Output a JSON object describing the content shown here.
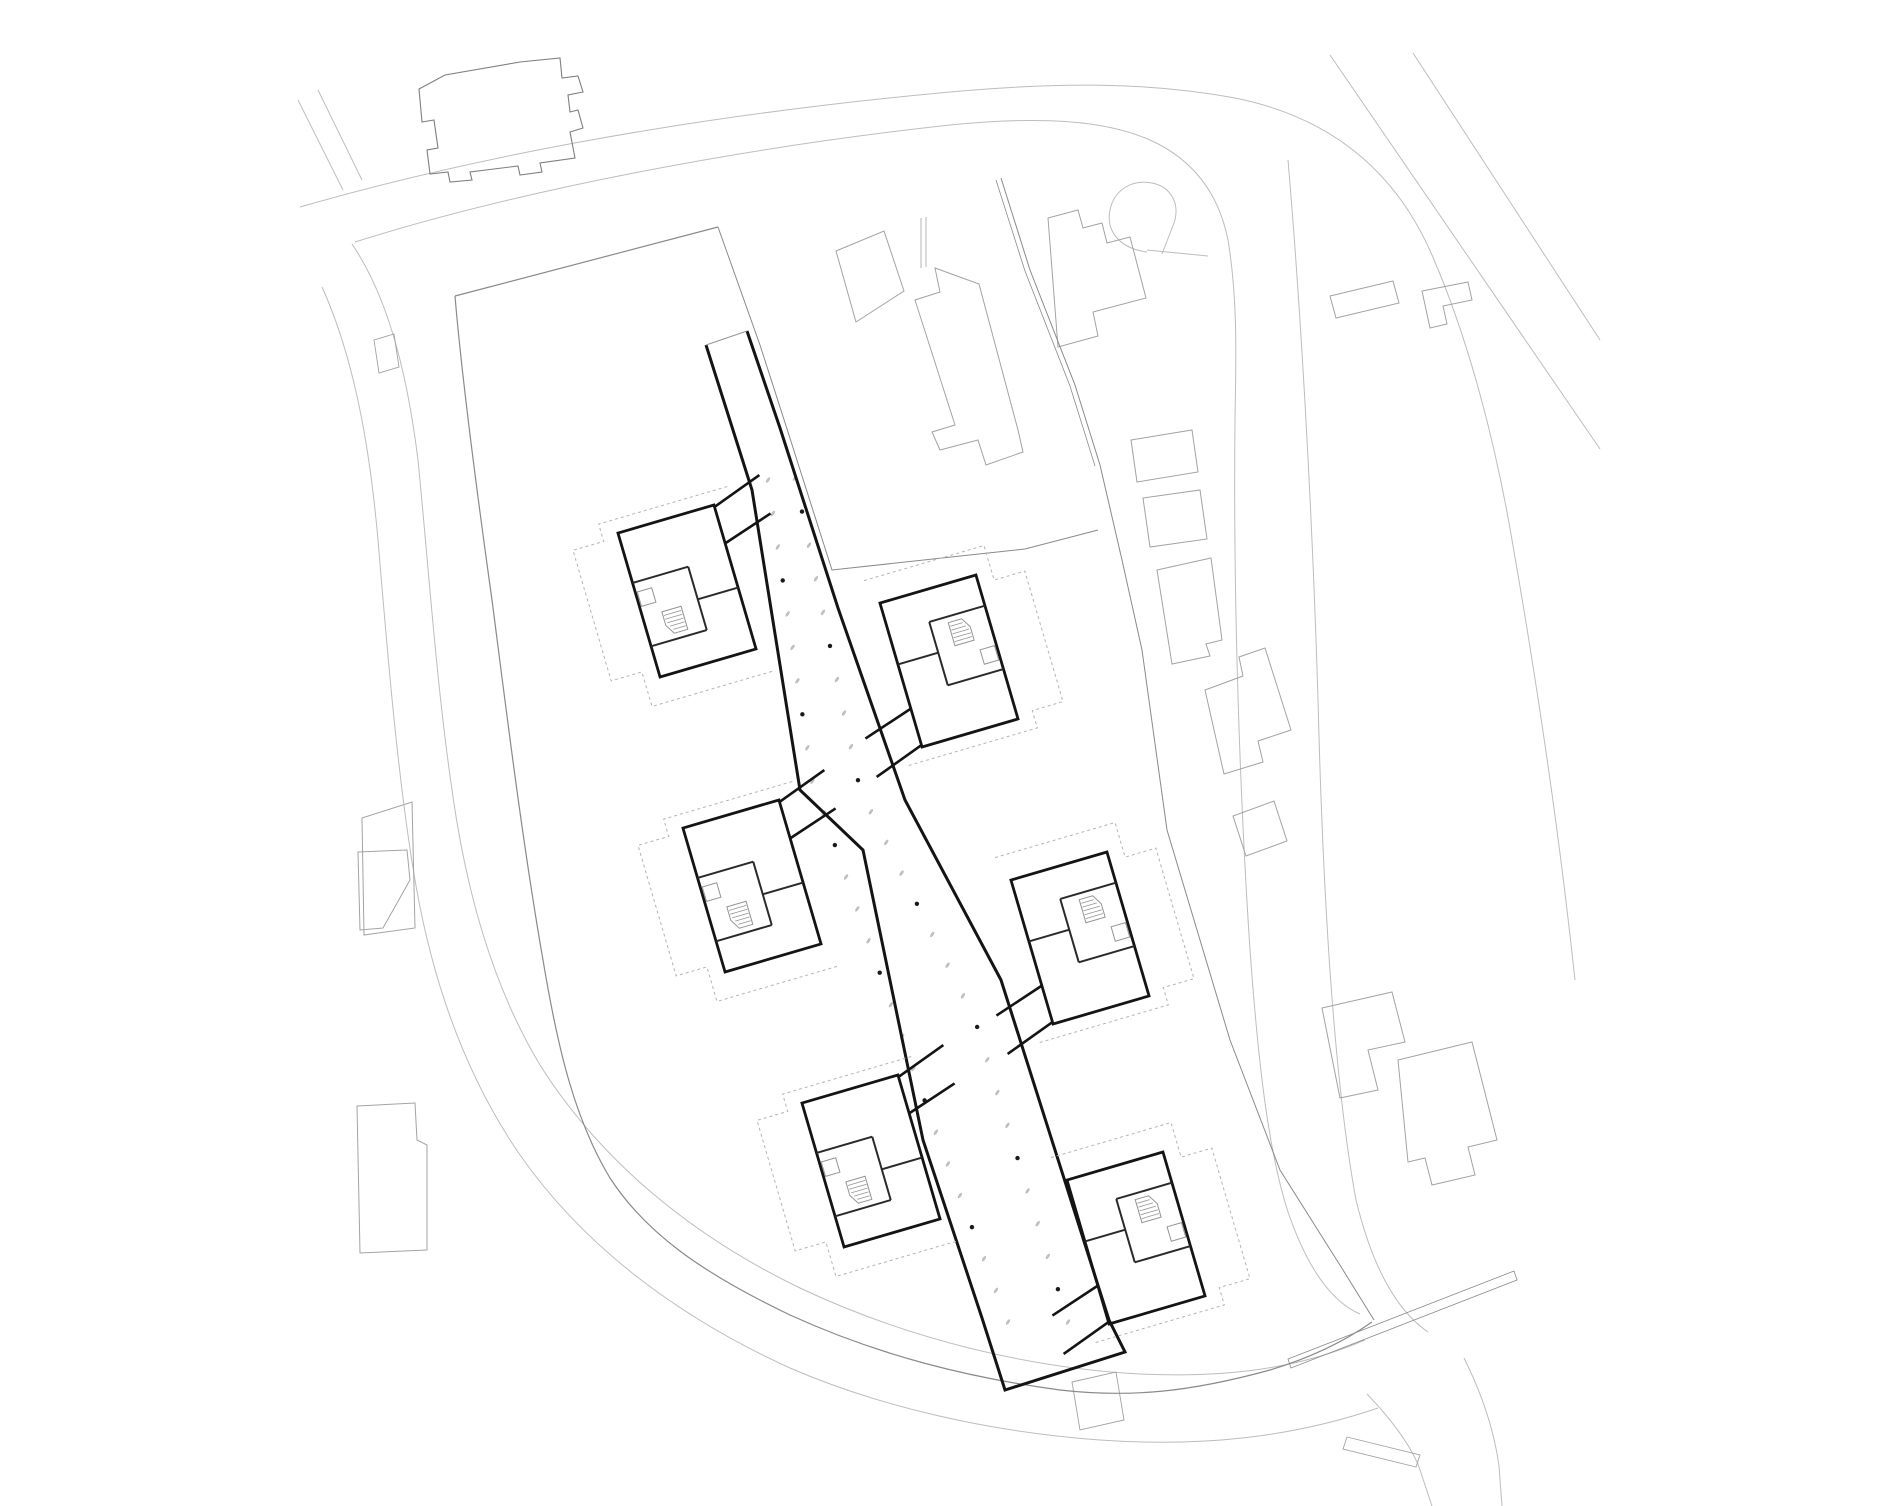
{
  "meta": {
    "title": "Architectural site plan — ground floor with six pavilions on a central spine",
    "canvas": {
      "width": 1880,
      "height": 1506
    },
    "background": "#ffffff"
  },
  "theme": {
    "road": "#bdbdbd",
    "road_light": "#c9c9c9",
    "context": "#a3a3a3",
    "context_dark": "#7f7f7f",
    "boundary": "#8a8a8a",
    "building": "#141414",
    "interior": "#2a2a2a",
    "detail_light": "#949494",
    "dashed_roof": "#b4b4b4",
    "column_light": "#bfbfbf",
    "column_dark": "#1a1a1a"
  },
  "drawing": {
    "roads": [
      {
        "name": "road-top-outer",
        "d": "M300,207 C480,155 700,115 950,92 C1060,82 1150,82 1235,98 C1330,117 1395,170 1432,255 C1468,338 1495,440 1512,540 C1540,700 1560,840 1575,980",
        "w": 1
      },
      {
        "name": "road-top-inner",
        "d": "M355,242 C520,190 740,148 950,125 C1040,116 1105,120 1150,140 C1190,158 1218,190 1228,240 C1238,300 1236,360 1235,420 C1233,600 1240,800 1250,950 C1258,1060 1268,1150 1288,1212 C1308,1270 1332,1302 1360,1314",
        "w": 1
      },
      {
        "name": "road-right-edge",
        "d": "M1288,160 C1300,300 1312,500 1318,700 C1323,900 1334,1080 1356,1200 C1372,1266 1396,1310 1428,1332",
        "w": 1
      },
      {
        "name": "road-diagonal-1",
        "d": "M1330,55 L1600,449",
        "w": 1
      },
      {
        "name": "road-diagonal-2",
        "d": "M1413,53 L1600,340",
        "w": 1
      },
      {
        "name": "road-left-inner",
        "d": "M352,244 C390,300 408,380 418,460 C428,560 436,680 452,790 C466,890 492,985 540,1065 C600,1160 690,1235 800,1288 C910,1340 1030,1368 1140,1374 C1230,1378 1300,1368 1365,1340",
        "w": 1
      },
      {
        "name": "road-left-outer",
        "d": "M322,287 C355,360 370,450 378,540 C388,660 398,780 415,880 C432,980 465,1075 520,1155 C585,1248 680,1318 790,1368 C880,1407 990,1432 1100,1440 C1200,1447 1290,1438 1378,1408",
        "w": 1
      },
      {
        "name": "road-bottom-branch-1",
        "d": "M1367,1394 C1392,1420 1408,1442 1418,1464 L1432,1506",
        "w": 1
      },
      {
        "name": "road-bottom-branch-2",
        "d": "M1464,1358 C1482,1394 1494,1430 1499,1466 L1502,1506",
        "w": 1
      },
      {
        "name": "road-top-left-spur-1",
        "d": "M298,100 L343,190",
        "w": 1
      },
      {
        "name": "road-top-left-spur-2",
        "d": "M318,90 L362,180",
        "w": 1
      },
      {
        "name": "road-top-right-curl",
        "d": "M1147,252 C1118,248 1106,230 1110,210 C1114,190 1132,179 1152,183 C1172,187 1180,205 1174,223 L1162,254",
        "w": 1
      },
      {
        "name": "road-top-right-stub",
        "d": "M1147,250 L1208,256",
        "w": 1
      }
    ],
    "boundary": [
      {
        "name": "site-boundary-west-south",
        "d": "M455,296 C462,380 478,500 492,600 C505,700 522,840 543,960 C558,1050 575,1120 610,1178 C645,1232 700,1272 790,1315 C880,1356 970,1378 1060,1390 C1130,1398 1190,1392 1270,1370 C1320,1355 1352,1336 1372,1322",
        "w": 1.2
      },
      {
        "name": "site-boundary-north",
        "d": "M455,296 L718,227",
        "w": 1.2
      },
      {
        "name": "parcel-line-inner-east",
        "d": "M718,227 L760,345 L788,432 L832,570 L1025,549 L1098,530",
        "w": 1
      },
      {
        "name": "parcel-line-outer-east-1",
        "d": "M1001,178 L1030,270 L1075,385 L1100,465 L1122,560 L1142,650 L1167,830 L1230,1040 L1280,1170 L1343,1270 L1374,1320",
        "w": 1
      },
      {
        "name": "parcel-line-outer-east-2",
        "d": "M996,180 L1025,271 L1070,386 L1095,466",
        "w": 0.8
      },
      {
        "name": "footpath-strip",
        "d": "M1288,1359 L1514,1271 L1517,1280 L1291,1368 Z",
        "w": 0.8
      }
    ],
    "context_buildings": [
      {
        "name": "neighbor-building-top-left",
        "d": "M419,89 L445,75 L520,62 L560,58 L562,78 L578,76 L583,92 L568,95 L570,112 L578,110 L583,128 L570,132 L575,158 L540,163 L542,172 L520,175 L518,166 L470,172 L472,180 L450,182 L448,172 L430,174 L427,150 L438,148 L434,120 L422,122 Z",
        "w": 1.1,
        "dark": true
      },
      {
        "name": "neighbor-building-top-middle-slab",
        "d": "M935,268 L979,284 L1018,430 L1023,452 L986,465 L978,440 L940,450 L932,432 L955,425 L915,300 L940,292 Z",
        "w": 1
      },
      {
        "name": "neighbor-building-top-middle-wing",
        "d": "M836,251 L884,231 L904,291 L856,322 Z",
        "w": 1
      },
      {
        "name": "neighbor-building-top-middle-stub",
        "d": "M921,218 L921,268 M926,217 L926,267",
        "w": 0.8
      },
      {
        "name": "neighbor-building-top-right",
        "d": "M1048,218 L1078,210 L1083,228 L1102,223 L1107,243 L1130,237 L1146,298 L1093,312 L1098,336 L1058,347 Z",
        "w": 1
      },
      {
        "name": "neighbor-building-right-rect-small",
        "d": "M1330,296 L1393,281 L1399,303 L1336,318 Z",
        "w": 1
      },
      {
        "name": "neighbor-building-right-l-shape",
        "d": "M1422,291 L1468,282 L1472,300 L1443,306 L1447,324 L1430,328 Z",
        "w": 1
      },
      {
        "name": "neighbor-building-east-rect-a",
        "d": "M1131,440 L1192,430 L1198,472 L1137,482 Z",
        "w": 1
      },
      {
        "name": "neighbor-building-east-rect-b",
        "d": "M1143,498 L1200,490 L1207,539 L1150,547 Z",
        "w": 1
      },
      {
        "name": "neighbor-building-east-tall",
        "d": "M1157,570 L1211,558 L1222,640 L1206,644 L1210,656 L1172,664 Z",
        "w": 1
      },
      {
        "name": "neighbor-building-east-house",
        "d": "M1205,690 L1243,676 L1239,657 L1265,648 L1291,730 L1258,741 L1263,762 L1224,774 Z",
        "w": 1
      },
      {
        "name": "neighbor-building-east-rect-c",
        "d": "M1233,816 L1274,801 L1287,841 L1246,856 Z",
        "w": 1
      },
      {
        "name": "neighbor-building-southeast-a",
        "d": "M1322,1008 L1392,992 L1405,1042 L1368,1050 L1378,1090 L1340,1098 Z",
        "w": 1
      },
      {
        "name": "neighbor-building-southeast-b",
        "d": "M1398,1060 L1472,1042 L1497,1140 L1468,1147 L1475,1175 L1432,1185 L1425,1158 L1408,1162 Z",
        "w": 1
      },
      {
        "name": "neighbor-building-west-trapezoid",
        "d": "M362,818 L412,802 L415,928 L364,935 Z",
        "w": 1
      },
      {
        "name": "neighbor-building-west-rect",
        "d": "M357,1106 L415,1103 L417,1140 L427,1145 L427,1250 L360,1253 Z",
        "w": 1
      },
      {
        "name": "neighbor-building-west-fragment",
        "d": "M358,852 L407,850 L410,880 L383,928 L360,930 Z",
        "w": 1
      },
      {
        "name": "driveway-spur-west",
        "d": "M374,340 L394,334 L399,367 L379,373 Z",
        "w": 0.9
      },
      {
        "name": "garage-rect-bottom",
        "d": "M1072,1382 L1116,1372 L1124,1420 L1080,1430 Z",
        "w": 0.9
      },
      {
        "name": "kerb-rect-bottom-right",
        "d": "M1347,1437 L1420,1455 L1416,1467 L1343,1449 Z",
        "w": 0.9
      }
    ],
    "complex": {
      "corridor": {
        "name": "spine-corridor-outline",
        "d": "M706,345 L752,490 L800,790 L863,850 L923,1140 L982,1318 L1005,1390 L1125,1352 L1109,1320 L1001,980 L905,800 L838,608 L780,428 L747,331",
        "w": 3
      },
      "corridor_cap": {
        "name": "spine-north-cap",
        "d": "M706,345 L747,331",
        "w": 1
      },
      "pavilion_prototype": {
        "outline": "M0,0 L100,0 L100,150 L0,150 Z",
        "interior": [
          "M0,52 L58,52",
          "M58,52 L58,118",
          "M0,118 L58,118",
          "M58,86 L100,86"
        ],
        "link": [
          "M100,2 L152,-16",
          "M100,40 L152,24"
        ],
        "dashed": "M118,-14 L-16,-14 L-16,4 L-48,4 L-48,140 L-16,140 L-16,176 L112,176",
        "square": {
          "x": 2,
          "y": 62,
          "w": 15,
          "h": 15
        },
        "stair": {
          "outline": "M20,88 L40,88 L40,112 L26,112 L20,102 Z",
          "treads": [
            "M21,92 L39,92",
            "M21,96 L39,96",
            "M22,100 L39,100",
            "M24,104 L39,104",
            "M26,108 L39,108"
          ]
        }
      },
      "instances": [
        {
          "name": "pavilion-1-northwest",
          "cx": 687,
          "cy": 591,
          "rot": -16.3
        },
        {
          "name": "pavilion-2-northeast",
          "cx": 949,
          "cy": 661,
          "rot": 163.7
        },
        {
          "name": "pavilion-3-middle-west",
          "cx": 752,
          "cy": 886,
          "rot": -16.3
        },
        {
          "name": "pavilion-4-middle-east",
          "cx": 1080,
          "cy": 938,
          "rot": 163.7
        },
        {
          "name": "pavilion-5-south-west",
          "cx": 871,
          "cy": 1161,
          "rot": -16.3
        },
        {
          "name": "pavilion-6-south-east",
          "cx": 1136,
          "cy": 1238,
          "rot": 163.7
        }
      ]
    },
    "columns": {
      "rows": [
        {
          "name": "column-row-west",
          "pts": [
            [
              768,
              480
            ],
            [
              812,
              780
            ],
            [
              935,
              1130
            ],
            [
              1008,
              1322
            ]
          ],
          "count": 27,
          "dark_every": [
            3,
            7,
            11,
            15,
            19,
            23
          ]
        },
        {
          "name": "column-row-east",
          "pts": [
            [
              795,
              478
            ],
            [
              860,
              790
            ],
            [
              975,
              1020
            ],
            [
              1068,
              1322
            ]
          ],
          "count": 27,
          "dark_every": [
            1,
            5,
            9,
            13,
            17,
            21,
            25
          ]
        }
      ],
      "light_mark": {
        "rx": 3.2,
        "ry": 1.4,
        "angle": -55
      },
      "dark_dot_r": 2.2
    }
  }
}
